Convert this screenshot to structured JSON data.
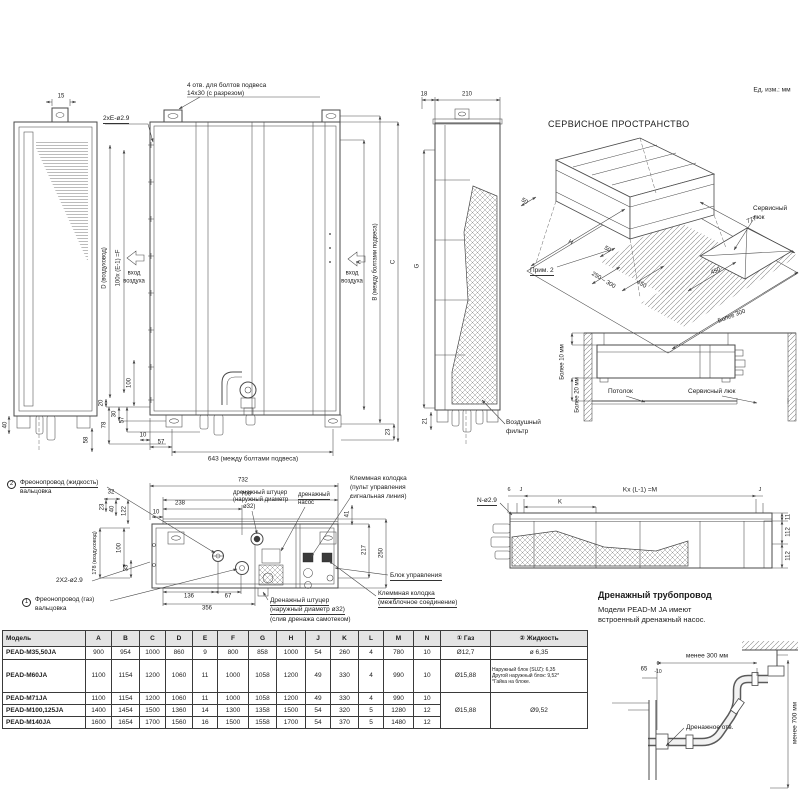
{
  "units_label": "Ед. изм.: мм",
  "rear_view": {
    "dim_15": "15",
    "dim_40": "40",
    "dim_58": "58"
  },
  "front_view": {
    "holes_note_line1": "4 отв. для болтов подвеса",
    "holes_note_line2": "14x30 (с разрезом)",
    "e_holes": "2xE-ø2.9",
    "duct_label": "D (воздуховод)",
    "pitch_label": "100x (E-1) =F",
    "air_in_left_line1": "вход",
    "air_in_left_line2": "воздуха",
    "air_in_right_line1": "вход",
    "air_in_right_line2": "воздуха",
    "dim_a": "A",
    "dim_b": "В (между болтами подвеса)",
    "dim_c": "C",
    "dim_100": "100",
    "dim_20": "20",
    "dim_78": "78",
    "dim_30": "30",
    "dim_57a": "57",
    "dim_10": "10",
    "dim_57b": "57",
    "dim_643": "643 (между болтами подвеса)",
    "dim_23": "23"
  },
  "side_view": {
    "dim_18": "18",
    "dim_210": "210",
    "dim_g": "G",
    "dim_21": "21",
    "filter_label_line1": "Воздушный",
    "filter_label_line2": "фильтр"
  },
  "service_space": {
    "title": "СЕРВИСНОЕ ПРОСТРАНСТВО",
    "dim_50_left": "50",
    "dim_h": "H",
    "note": "Прим. 2",
    "dim_50_mid": "50",
    "dim_250_300": "250 – 300",
    "dim_450_left": "450",
    "dim_777": "777",
    "hatch_label_line1": "Сервисный",
    "hatch_label_line2": "люк",
    "dim_450_right": "450",
    "dim_more300": "Более 300"
  },
  "ceiling_detail": {
    "dim_more10": "Более 10 мм",
    "dim_more20": "Более 20 мм",
    "ceiling_label": "Потолок",
    "hatch_label": "Сервисный люк"
  },
  "bottom_view": {
    "callout2_num": "2",
    "callout2_line1": "Фреонопровод (жидкость)",
    "callout2_line2": "вальцовка",
    "callout1_num": "1",
    "callout1_line1": "Фреонопровод (газ)",
    "callout1_line2": "вальцовка",
    "holes": "2X2-ø2.9",
    "dim_732": "732",
    "dim_700": "700",
    "dim_32": "32",
    "dim_238": "238",
    "dim_10": "10",
    "dim_23": "23",
    "dim_40": "40",
    "dim_122": "122",
    "duct_dim": "178 (воздуховод)",
    "dim_100": "100",
    "dim_33": "33",
    "dim_136": "136",
    "dim_67": "67",
    "dim_356": "356",
    "dim_41": "41",
    "dim_217": "217",
    "dim_250": "250",
    "drain_stub_top_line1": "дренажный штуцер",
    "drain_stub_top_line2": "(наружный диаметр",
    "drain_stub_top_line3": "ø32)",
    "drain_pump_line1": "дренажный",
    "drain_pump_line2": "насос",
    "terminal1_line1": "Клеммная колодка",
    "terminal1_line2": "(пульт управления",
    "terminal1_line3": "сигнальная линия)",
    "control_box": "Блок управления",
    "terminal2_line1": "Клеммная колодка",
    "terminal2_line2": "(межблочное соединение)",
    "drain_stub_bottom_line1": "Дренажный штуцер",
    "drain_stub_bottom_line2": "(наружный диаметр ø32)",
    "drain_stub_bottom_line3": "(слив дренажа самотеком)"
  },
  "top_view": {
    "holes": "N-ø2.9",
    "dim_6": "6",
    "dim_j_left": "J",
    "dim_m": "Kx (L-1) =M",
    "dim_k": "K",
    "dim_j_right": "J",
    "dim_11": "11",
    "dim_112a": "112",
    "dim_112b": "112"
  },
  "drain_section": {
    "title": "Дренажный трубопровод",
    "note_line1": "Модели PEAD-M JA имеют",
    "note_line2": "встроенный дренажный насос.",
    "dim_300": "менее 300 мм",
    "dim_65": "65",
    "tol_top": "0",
    "tol_bottom": "-10",
    "hole_label": "Дренажное отв.",
    "dim_700": "менее 700 мм"
  },
  "table": {
    "headers": [
      "Модель",
      "A",
      "B",
      "C",
      "D",
      "E",
      "F",
      "G",
      "H",
      "J",
      "K",
      "L",
      "M",
      "N",
      "① Газ",
      "② Жидкость"
    ],
    "rows": [
      {
        "model": "PEAD-M35,50JA",
        "values": [
          "900",
          "954",
          "1000",
          "860",
          "9",
          "800",
          "858",
          "1000",
          "54",
          "260",
          "4",
          "780",
          "10"
        ],
        "gas": "Ø12,7",
        "liquid": "ø 6,35"
      },
      {
        "model": "PEAD-M60JA",
        "values": [
          "1100",
          "1154",
          "1200",
          "1060",
          "11",
          "1000",
          "1058",
          "1200",
          "49",
          "330",
          "4",
          "990",
          "10"
        ],
        "gas": "Ø15,88",
        "liquid_lines": [
          "Наружный блок (SUZ): 6,35",
          "Другой наружный блок: 9,52*",
          "*Гайка на блоке."
        ]
      },
      {
        "model": "PEAD-M71JA",
        "values": [
          "1100",
          "1154",
          "1200",
          "1060",
          "11",
          "1000",
          "1058",
          "1200",
          "49",
          "330",
          "4",
          "990",
          "10"
        ]
      },
      {
        "model": "PEAD-M100,125JA",
        "values": [
          "1400",
          "1454",
          "1500",
          "1360",
          "14",
          "1300",
          "1358",
          "1500",
          "54",
          "320",
          "5",
          "1280",
          "12"
        ]
      },
      {
        "model": "PEAD-M140JA",
        "values": [
          "1600",
          "1654",
          "1700",
          "1560",
          "16",
          "1500",
          "1558",
          "1700",
          "54",
          "370",
          "5",
          "1480",
          "12"
        ]
      }
    ],
    "gas_merged": "Ø15,88",
    "liquid_merged": "Ø9,52"
  },
  "colors": {
    "line": "#4a4a4a",
    "text": "#1c1c1c",
    "table_header_bg": "#e4e4e4"
  }
}
